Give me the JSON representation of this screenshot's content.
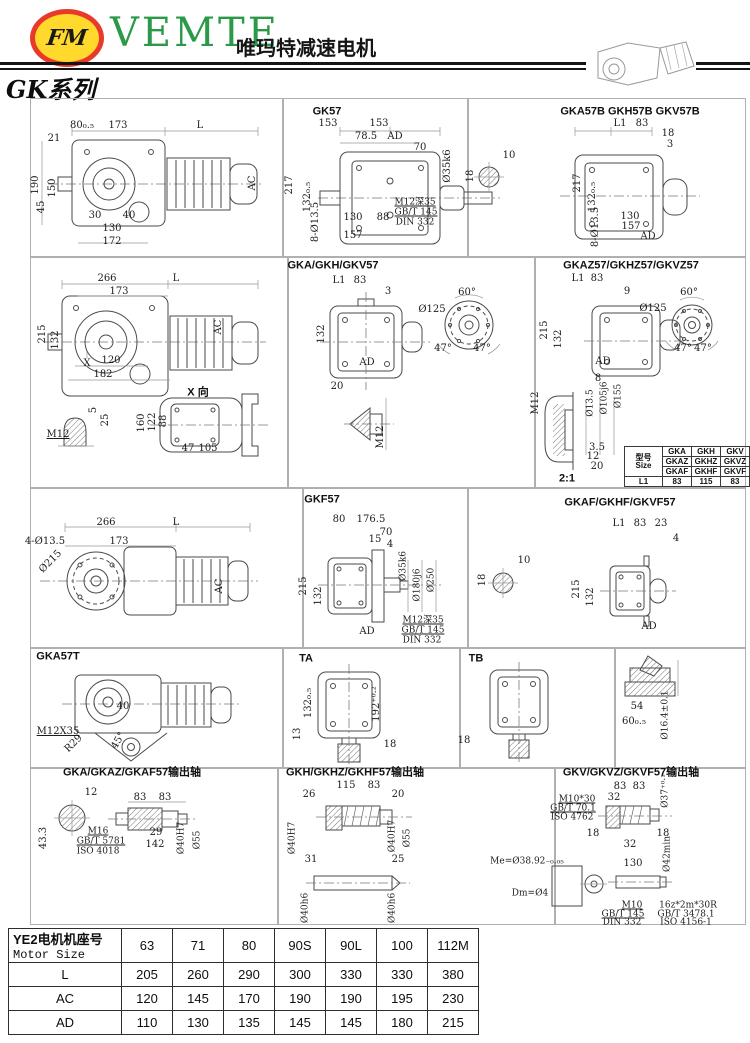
{
  "header": {
    "logo_monogram": "FM",
    "brand": "VEMTE",
    "brand_cn": "唯玛特减速电机",
    "series": "GK系列"
  },
  "titles": [
    {
      "t": "GK57",
      "x": 327,
      "y": 112
    },
    {
      "t": "GKA57B GKH57B GKV57B",
      "x": 630,
      "y": 112
    },
    {
      "t": "GKA/GKH/GKV57",
      "x": 333,
      "y": 266
    },
    {
      "t": "GKAZ57/GKHZ57/GKVZ57",
      "x": 631,
      "y": 266
    },
    {
      "t": "X 向",
      "x": 198,
      "y": 393
    },
    {
      "t": "2:1",
      "x": 567,
      "y": 479
    },
    {
      "t": "GKF57",
      "x": 322,
      "y": 500
    },
    {
      "t": "GKAF/GKHF/GKVF57",
      "x": 620,
      "y": 503
    },
    {
      "t": "GKA57T",
      "x": 58,
      "y": 657
    },
    {
      "t": "TA",
      "x": 306,
      "y": 659
    },
    {
      "t": "TB",
      "x": 476,
      "y": 659
    },
    {
      "t": "GKA/GKAZ/GKAF57输出轴",
      "x": 132,
      "y": 773
    },
    {
      "t": "GKH/GKHZ/GKHF57输出轴",
      "x": 355,
      "y": 773
    },
    {
      "t": "GKV/GKVZ/GKVF57输出轴",
      "x": 631,
      "y": 773
    }
  ],
  "labels": [
    {
      "t": "80₀.₅",
      "x": 82,
      "y": 126
    },
    {
      "t": "173",
      "x": 118,
      "y": 126
    },
    {
      "t": "L",
      "x": 200,
      "y": 126
    },
    {
      "t": "21",
      "x": 54,
      "y": 139
    },
    {
      "t": "190",
      "x": 36,
      "y": 185,
      "r": -90
    },
    {
      "t": "150",
      "x": 53,
      "y": 188,
      "r": -90
    },
    {
      "t": "45",
      "x": 42,
      "y": 207,
      "r": -90
    },
    {
      "t": "30",
      "x": 95,
      "y": 216
    },
    {
      "t": "40",
      "x": 129,
      "y": 216
    },
    {
      "t": "130",
      "x": 112,
      "y": 229
    },
    {
      "t": "172",
      "x": 112,
      "y": 242
    },
    {
      "t": "AC",
      "x": 253,
      "y": 183,
      "r": -90
    },
    {
      "t": "153",
      "x": 328,
      "y": 124
    },
    {
      "t": "153",
      "x": 379,
      "y": 124
    },
    {
      "t": "78.5",
      "x": 366,
      "y": 137
    },
    {
      "t": "AD",
      "x": 395,
      "y": 137
    },
    {
      "t": "70",
      "x": 420,
      "y": 148
    },
    {
      "t": "Ø35k6",
      "x": 448,
      "y": 166,
      "r": -90
    },
    {
      "t": "217",
      "x": 290,
      "y": 185,
      "r": -90
    },
    {
      "t": "132₀.₅",
      "x": 308,
      "y": 197,
      "r": -90
    },
    {
      "t": "8-Ø13.5",
      "x": 316,
      "y": 222,
      "r": -90
    },
    {
      "t": "130",
      "x": 353,
      "y": 218
    },
    {
      "t": "88",
      "x": 383,
      "y": 218
    },
    {
      "t": "157",
      "x": 353,
      "y": 236
    },
    {
      "t": "M12深35",
      "x": 415,
      "y": 203,
      "u": true,
      "fs": 9
    },
    {
      "t": "GB/T 145",
      "x": 416,
      "y": 213,
      "u": true,
      "fs": 9
    },
    {
      "t": "DIN 332",
      "x": 415,
      "y": 223,
      "fs": 9
    },
    {
      "t": "10",
      "x": 509,
      "y": 156
    },
    {
      "t": "18",
      "x": 471,
      "y": 176,
      "r": -90
    },
    {
      "t": "L1",
      "x": 620,
      "y": 124
    },
    {
      "t": "83",
      "x": 642,
      "y": 124
    },
    {
      "t": "18",
      "x": 668,
      "y": 134
    },
    {
      "t": "3",
      "x": 670,
      "y": 145
    },
    {
      "t": "217",
      "x": 578,
      "y": 183,
      "r": -90
    },
    {
      "t": "132₀.₅",
      "x": 593,
      "y": 197,
      "r": -90
    },
    {
      "t": "8-Ø13.5",
      "x": 596,
      "y": 227,
      "r": -90
    },
    {
      "t": "130",
      "x": 630,
      "y": 217
    },
    {
      "t": "157",
      "x": 631,
      "y": 227
    },
    {
      "t": "AD",
      "x": 648,
      "y": 237
    },
    {
      "t": "266",
      "x": 107,
      "y": 279
    },
    {
      "t": "173",
      "x": 119,
      "y": 292
    },
    {
      "t": "L",
      "x": 176,
      "y": 279
    },
    {
      "t": "215",
      "x": 43,
      "y": 334,
      "r": -90
    },
    {
      "t": "132",
      "x": 56,
      "y": 340,
      "r": -90
    },
    {
      "t": "120",
      "x": 111,
      "y": 361
    },
    {
      "t": "182",
      "x": 103,
      "y": 375
    },
    {
      "t": "X",
      "x": 87,
      "y": 364
    },
    {
      "t": "AC",
      "x": 219,
      "y": 327,
      "r": -90
    },
    {
      "t": "M12",
      "x": 58,
      "y": 435,
      "u": true
    },
    {
      "t": "5",
      "x": 94,
      "y": 410,
      "r": -90
    },
    {
      "t": "25",
      "x": 106,
      "y": 420,
      "r": -90
    },
    {
      "t": "160",
      "x": 142,
      "y": 423,
      "r": -90
    },
    {
      "t": "122",
      "x": 153,
      "y": 422,
      "r": -90
    },
    {
      "t": "88",
      "x": 164,
      "y": 421,
      "r": -90
    },
    {
      "t": "47",
      "x": 188,
      "y": 449
    },
    {
      "t": "105",
      "x": 208,
      "y": 449
    },
    {
      "t": "20",
      "x": 337,
      "y": 387
    },
    {
      "t": "M12",
      "x": 381,
      "y": 437,
      "r": -90
    },
    {
      "t": "L1",
      "x": 339,
      "y": 281
    },
    {
      "t": "83",
      "x": 360,
      "y": 281
    },
    {
      "t": "3",
      "x": 388,
      "y": 292
    },
    {
      "t": "132",
      "x": 322,
      "y": 334,
      "r": -90
    },
    {
      "t": "AD",
      "x": 367,
      "y": 363
    },
    {
      "t": "Ø125",
      "x": 432,
      "y": 310
    },
    {
      "t": "60°",
      "x": 467,
      "y": 293
    },
    {
      "t": "47°",
      "x": 443,
      "y": 349
    },
    {
      "t": "47°",
      "x": 482,
      "y": 349
    },
    {
      "t": "L1",
      "x": 578,
      "y": 279
    },
    {
      "t": "83",
      "x": 597,
      "y": 279
    },
    {
      "t": "9",
      "x": 627,
      "y": 292
    },
    {
      "t": "215",
      "x": 545,
      "y": 330,
      "r": -90
    },
    {
      "t": "132",
      "x": 559,
      "y": 339,
      "r": -90
    },
    {
      "t": "AD",
      "x": 603,
      "y": 362
    },
    {
      "t": "Ø125",
      "x": 653,
      "y": 309
    },
    {
      "t": "60°",
      "x": 689,
      "y": 293
    },
    {
      "t": "47°",
      "x": 683,
      "y": 349
    },
    {
      "t": "47°",
      "x": 703,
      "y": 349
    },
    {
      "t": "8",
      "x": 598,
      "y": 379
    },
    {
      "t": "M12",
      "x": 536,
      "y": 403,
      "r": -90
    },
    {
      "t": "Ø13.5",
      "x": 591,
      "y": 403,
      "r": -90,
      "fs": 9
    },
    {
      "t": "Ø105j6",
      "x": 605,
      "y": 398,
      "r": -90,
      "fs": 9
    },
    {
      "t": "Ø155",
      "x": 619,
      "y": 396,
      "r": -90,
      "fs": 9
    },
    {
      "t": "3.5",
      "x": 597,
      "y": 448
    },
    {
      "t": "12",
      "x": 593,
      "y": 457
    },
    {
      "t": "20",
      "x": 597,
      "y": 467
    },
    {
      "t": "266",
      "x": 106,
      "y": 523
    },
    {
      "t": "173",
      "x": 119,
      "y": 542
    },
    {
      "t": "L",
      "x": 176,
      "y": 523
    },
    {
      "t": "4-Ø13.5",
      "x": 45,
      "y": 542
    },
    {
      "t": "Ø215",
      "x": 51,
      "y": 562,
      "r": -45
    },
    {
      "t": "AC",
      "x": 220,
      "y": 586,
      "r": -90
    },
    {
      "t": "80",
      "x": 339,
      "y": 520
    },
    {
      "t": "176.5",
      "x": 371,
      "y": 520
    },
    {
      "t": "70",
      "x": 386,
      "y": 533
    },
    {
      "t": "15",
      "x": 375,
      "y": 540
    },
    {
      "t": "4",
      "x": 390,
      "y": 545
    },
    {
      "t": "Ø35k6",
      "x": 404,
      "y": 566,
      "r": -90,
      "fs": 9
    },
    {
      "t": "Ø180j6",
      "x": 418,
      "y": 585,
      "r": -90,
      "fs": 9
    },
    {
      "t": "Ø250",
      "x": 432,
      "y": 580,
      "r": -90,
      "fs": 9
    },
    {
      "t": "215",
      "x": 304,
      "y": 586,
      "r": -90
    },
    {
      "t": "132",
      "x": 319,
      "y": 596,
      "r": -90
    },
    {
      "t": "AD",
      "x": 367,
      "y": 632
    },
    {
      "t": "M12深35",
      "x": 423,
      "y": 621,
      "u": true,
      "fs": 9
    },
    {
      "t": "GB/T 145",
      "x": 423,
      "y": 631,
      "u": true,
      "fs": 9
    },
    {
      "t": "DIN 332",
      "x": 422,
      "y": 641,
      "fs": 9
    },
    {
      "t": "10",
      "x": 524,
      "y": 561
    },
    {
      "t": "18",
      "x": 483,
      "y": 580,
      "r": -90
    },
    {
      "t": "L1",
      "x": 619,
      "y": 524
    },
    {
      "t": "83",
      "x": 640,
      "y": 524
    },
    {
      "t": "23",
      "x": 661,
      "y": 524
    },
    {
      "t": "4",
      "x": 676,
      "y": 539
    },
    {
      "t": "215",
      "x": 577,
      "y": 589,
      "r": -90
    },
    {
      "t": "132",
      "x": 591,
      "y": 597,
      "r": -90
    },
    {
      "t": "AD",
      "x": 649,
      "y": 627
    },
    {
      "t": "40",
      "x": 123,
      "y": 707
    },
    {
      "t": "M12X35",
      "x": 58,
      "y": 732,
      "u": true
    },
    {
      "t": "R29",
      "x": 74,
      "y": 744,
      "r": -45
    },
    {
      "t": "45°",
      "x": 119,
      "y": 741,
      "r": -60
    },
    {
      "t": "132₀.₅",
      "x": 309,
      "y": 703,
      "r": -90
    },
    {
      "t": "13",
      "x": 298,
      "y": 734,
      "r": -90
    },
    {
      "t": "192⁺⁰·²",
      "x": 377,
      "y": 704,
      "r": -90
    },
    {
      "t": "18",
      "x": 390,
      "y": 745
    },
    {
      "t": "18",
      "x": 464,
      "y": 741
    },
    {
      "t": "54",
      "x": 637,
      "y": 707
    },
    {
      "t": "60₀.₅",
      "x": 634,
      "y": 722
    },
    {
      "t": "Ø16.4±0.1",
      "x": 666,
      "y": 715,
      "r": -90,
      "fs": 9
    },
    {
      "t": "12",
      "x": 91,
      "y": 793
    },
    {
      "t": "43.3",
      "x": 44,
      "y": 838,
      "r": -90
    },
    {
      "t": "83",
      "x": 140,
      "y": 798
    },
    {
      "t": "83",
      "x": 165,
      "y": 798
    },
    {
      "t": "29",
      "x": 156,
      "y": 833
    },
    {
      "t": "142",
      "x": 155,
      "y": 845
    },
    {
      "t": "Ø40H7",
      "x": 182,
      "y": 838,
      "r": -90,
      "fs": 9
    },
    {
      "t": "Ø55",
      "x": 198,
      "y": 840,
      "r": -90,
      "fs": 9
    },
    {
      "t": "M16",
      "x": 98,
      "y": 832,
      "u": true,
      "fs": 9
    },
    {
      "t": "GB/T 5781",
      "x": 101,
      "y": 842,
      "u": true,
      "fs": 9
    },
    {
      "t": "ISO 4018",
      "x": 98,
      "y": 852,
      "fs": 9
    },
    {
      "t": "26",
      "x": 309,
      "y": 795
    },
    {
      "t": "115",
      "x": 346,
      "y": 786
    },
    {
      "t": "83",
      "x": 374,
      "y": 786
    },
    {
      "t": "20",
      "x": 398,
      "y": 795
    },
    {
      "t": "Ø40H7",
      "x": 293,
      "y": 838,
      "r": -90,
      "fs": 9
    },
    {
      "t": "Ø40H7",
      "x": 393,
      "y": 836,
      "r": -90,
      "fs": 9
    },
    {
      "t": "Ø55",
      "x": 408,
      "y": 838,
      "r": -90,
      "fs": 9
    },
    {
      "t": "31",
      "x": 311,
      "y": 860
    },
    {
      "t": "25",
      "x": 398,
      "y": 860
    },
    {
      "t": "Ø40h6",
      "x": 306,
      "y": 908,
      "r": -90,
      "fs": 9
    },
    {
      "t": "Ø40h6",
      "x": 393,
      "y": 908,
      "r": -90,
      "fs": 9
    },
    {
      "t": "M10*30",
      "x": 577,
      "y": 800,
      "u": true,
      "fs": 9
    },
    {
      "t": "GB/T 70.1",
      "x": 573,
      "y": 809,
      "u": true,
      "fs": 9
    },
    {
      "t": "ISO 4762",
      "x": 572,
      "y": 818,
      "fs": 9
    },
    {
      "t": "83",
      "x": 620,
      "y": 787
    },
    {
      "t": "83",
      "x": 639,
      "y": 787
    },
    {
      "t": "32",
      "x": 614,
      "y": 798
    },
    {
      "t": "Ø37⁺⁰·¹",
      "x": 666,
      "y": 791,
      "r": -90,
      "fs": 9
    },
    {
      "t": "18",
      "x": 593,
      "y": 834
    },
    {
      "t": "18",
      "x": 663,
      "y": 834
    },
    {
      "t": "32",
      "x": 630,
      "y": 845
    },
    {
      "t": "Ø42min",
      "x": 668,
      "y": 854,
      "r": -90,
      "fs": 9
    },
    {
      "t": "130",
      "x": 633,
      "y": 864
    },
    {
      "t": "Me=Ø38.92₋₀.₀₅",
      "x": 527,
      "y": 862,
      "fs": 9
    },
    {
      "t": "Dm=Ø4",
      "x": 530,
      "y": 894,
      "fs": 9
    },
    {
      "t": "M10",
      "x": 632,
      "y": 906,
      "u": true,
      "fs": 9
    },
    {
      "t": "GB/T 145",
      "x": 623,
      "y": 915,
      "u": true,
      "fs": 9
    },
    {
      "t": "DIN 332",
      "x": 622,
      "y": 923,
      "fs": 9
    },
    {
      "t": "16z*2m*30R",
      "x": 688,
      "y": 906,
      "fs": 9
    },
    {
      "t": "GB/T 3478.1",
      "x": 686,
      "y": 915,
      "fs": 9
    },
    {
      "t": "ISO 4156-1",
      "x": 686,
      "y": 923,
      "fs": 9
    }
  ],
  "size_table": {
    "header_cn": "型号",
    "header_en": "Size",
    "models": [
      [
        "GKA",
        "GKH",
        "GKV"
      ],
      [
        "GKAZ",
        "GKHZ",
        "GKVZ"
      ],
      [
        "GKAF",
        "GKHF",
        "GKVF"
      ]
    ],
    "l1": [
      "L1",
      "83",
      "115",
      "83"
    ]
  },
  "motor_table": {
    "header_cn": "YE2电机机座号",
    "header_en": "Motor Size",
    "frames": [
      "63",
      "71",
      "80",
      "90S",
      "90L",
      "100",
      "112M"
    ],
    "rows": [
      {
        "label": "L",
        "values": [
          "205",
          "260",
          "290",
          "300",
          "330",
          "330",
          "380"
        ]
      },
      {
        "label": "AC",
        "values": [
          "120",
          "145",
          "170",
          "190",
          "190",
          "195",
          "230"
        ]
      },
      {
        "label": "AD",
        "values": [
          "110",
          "130",
          "135",
          "145",
          "145",
          "180",
          "215"
        ]
      }
    ]
  }
}
